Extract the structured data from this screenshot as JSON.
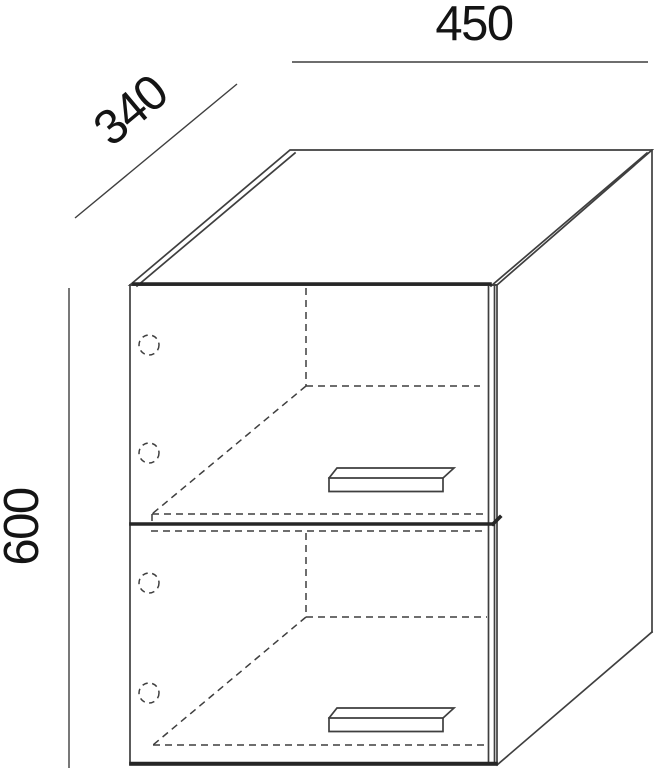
{
  "colors": {
    "line": "#3f3f3f",
    "thick-line": "#262626",
    "text": "#141414",
    "background": "#ffffff"
  },
  "drawing": {
    "type": "furniture-dimension-drawing",
    "subject": "two-door wall cabinet, axonometric view",
    "dimensions": {
      "width": {
        "label": "450"
      },
      "depth": {
        "label": "340"
      },
      "height": {
        "label": "600"
      }
    }
  }
}
